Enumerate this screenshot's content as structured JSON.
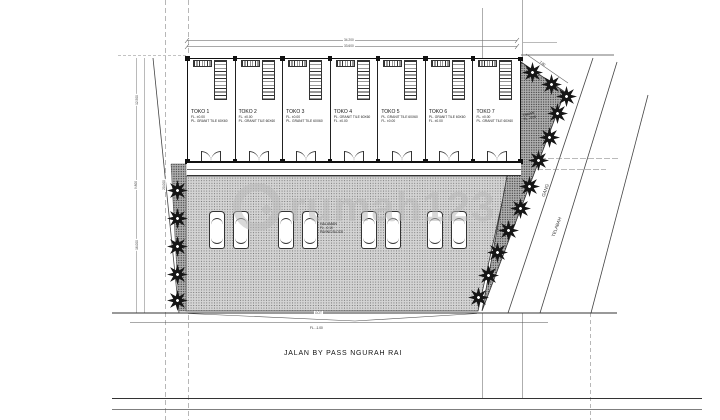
{
  "watermark": {
    "text": "rumah123"
  },
  "building": {
    "units": [
      {
        "name": "TOKO 1",
        "line1": "FL. ±0.00",
        "line2": "PL. GRANIT TILE 60X60"
      },
      {
        "name": "TOKO 2",
        "line1": "FL. ±0.00",
        "line2": "PL. GRANIT TILE 60X60"
      },
      {
        "name": "TOKO 3",
        "line1": "FL. ±0.00",
        "line2": "PL. GRANIT TILE 60X60"
      },
      {
        "name": "TOKO 4",
        "line1": "PL. GRANIT TILE 60X60",
        "line2": "FL. ±0.00"
      },
      {
        "name": "TOKO 5",
        "line1": "PL. GRANIT TILE 60X60",
        "line2": "FL. ±0.00"
      },
      {
        "name": "TOKO 6",
        "line1": "PL. GRANIT TILE 60X60",
        "line2": "FL. ±0.00"
      },
      {
        "name": "TOKO 7",
        "line1": "FL. ±0.00",
        "line2": "PL. GRANIT TILE 60X60"
      }
    ]
  },
  "yard": {
    "name": "HALAMAN",
    "level": "FL. -0.10",
    "finish": "PAVING BLOCK"
  },
  "garden": {
    "name": "TAMAN",
    "level": "FL. -0.05"
  },
  "roads": {
    "main": "JALAN BY PASS NGURAH RAI",
    "alley": "GANG",
    "channel": "TELABAH",
    "gutter": "GOT",
    "gutter_level": "FL. -1.00"
  },
  "dimensions": {
    "top_outer": "34.200",
    "top_inner": "33.600",
    "left_top": "12.500",
    "left_mid": "9.800",
    "left_inner": "20.000",
    "left_bottom": "16.000",
    "garden_edge": "7.80"
  }
}
